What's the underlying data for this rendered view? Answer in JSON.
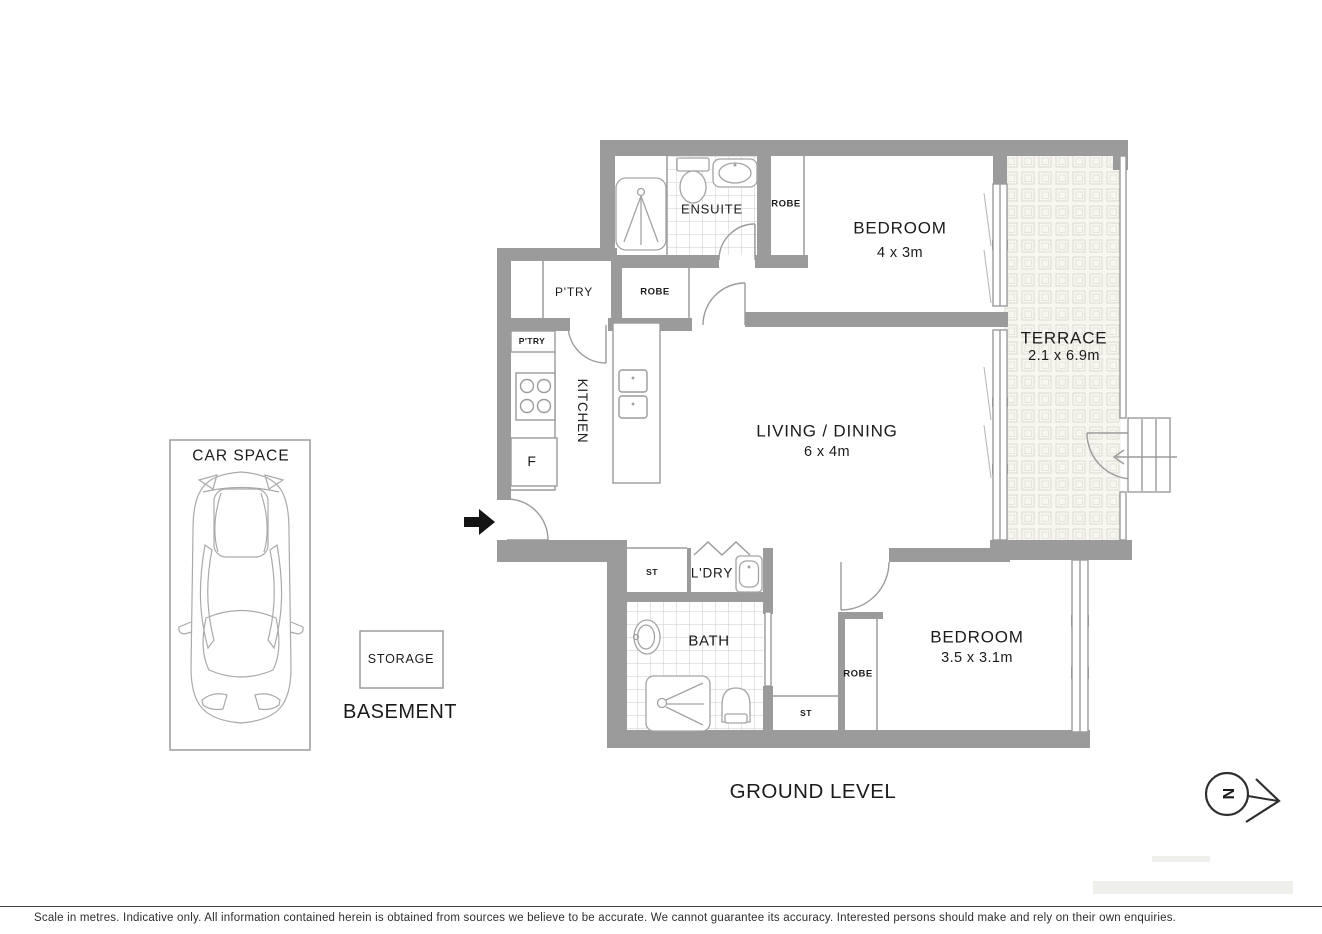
{
  "plan": {
    "level_title": "GROUND LEVEL",
    "basement_title": "BASEMENT",
    "rooms": {
      "bedroom1": {
        "name": "BEDROOM",
        "dims": "4 x 3m"
      },
      "bedroom2": {
        "name": "BEDROOM",
        "dims": "3.5 x 3.1m"
      },
      "living_dining": {
        "name": "LIVING / DINING",
        "dims": "6 x 4m"
      },
      "terrace": {
        "name": "TERRACE",
        "dims": "2.1 x 6.9m"
      },
      "ensuite": {
        "name": "ENSUITE"
      },
      "bath": {
        "name": "BATH"
      },
      "laundry": {
        "name": "L'DRY"
      },
      "kitchen": {
        "name": "KITCHEN"
      },
      "pantry": {
        "name": "P'TRY"
      },
      "pantry_cupboard": {
        "name": "P'TRY"
      },
      "robe_bedroom1": {
        "name": "ROBE"
      },
      "robe_hall": {
        "name": "ROBE"
      },
      "robe_bedroom2": {
        "name": "ROBE"
      },
      "store_laundry": {
        "name": "ST"
      },
      "store_bedroom2": {
        "name": "ST"
      },
      "fridge": {
        "name": "F"
      },
      "car_space": {
        "name": "CAR SPACE"
      },
      "storage": {
        "name": "STORAGE"
      }
    },
    "compass": {
      "north_letter": "N"
    }
  },
  "footer": {
    "disclaimer": "Scale in metres. Indicative only. All information contained herein is obtained from sources we believe to be accurate. We cannot guarantee its accuracy. Interested persons should make and rely on their own enquiries."
  },
  "colors": {
    "wall": "#9b9b9b",
    "label_text": "#1b1b1b",
    "terrace_bg": "#f7f6f1",
    "tile_line": "#dcdad1",
    "bath_grid": "#cbcbcb",
    "entry_arrow": "#141414",
    "compass": "#2f2f2f",
    "footer_rule": "#3f3f3f"
  }
}
